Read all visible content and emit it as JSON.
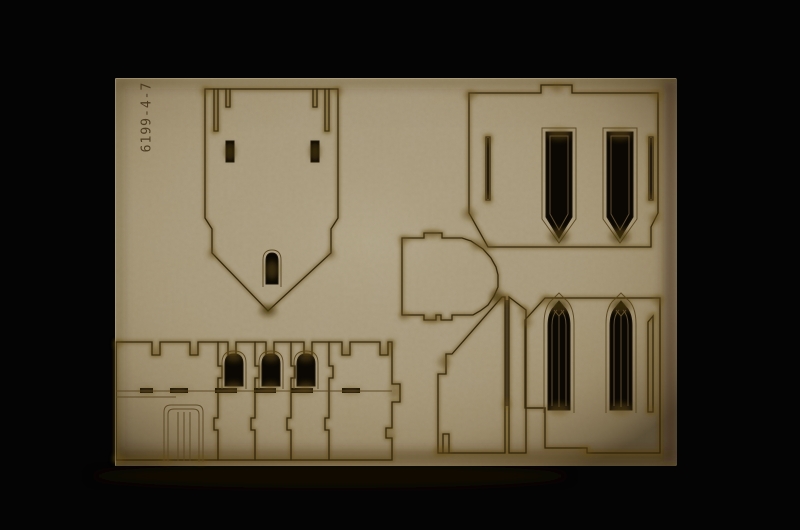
{
  "scene": {
    "type": "photograph",
    "subject": "Laser-cut MDF model kit sheet with gothic building parts on a black background",
    "background_color": "#040404"
  },
  "sheet": {
    "part_number": "6199-4-7",
    "colors": {
      "mdf_base": "#a99c82",
      "mdf_edge_light": "#d8c9a4",
      "scorch": "#63490f",
      "scorch_dark": "#2e2008",
      "cut_line": "#2b2008",
      "cutout": "#0b0804",
      "slot_fill": "#241b0e",
      "etch_line": "#57431d",
      "etch_text": "#46351a",
      "tracery": "#6e5a38"
    }
  },
  "pieces": [
    {
      "name": "tower-gable-piece",
      "features": "pointed base, top tab slots, two rectangular holes, small arched window"
    },
    {
      "name": "upper-window-panel-piece",
      "features": "two lancet windows oriented upside down, side tab slots"
    },
    {
      "name": "apse-floor-piece",
      "features": "half-octagon faceted edge with alignment tabs"
    },
    {
      "name": "sloped-side-wall-piece",
      "features": "angled roofline, long vertical slot, bottom slot"
    },
    {
      "name": "lower-window-panel-piece",
      "features": "two pointed gothic windows with tracery, side slot"
    },
    {
      "name": "battlement-wall-piece",
      "features": "crenellated parapet, three arched windows, planked door, tab slots"
    }
  ]
}
